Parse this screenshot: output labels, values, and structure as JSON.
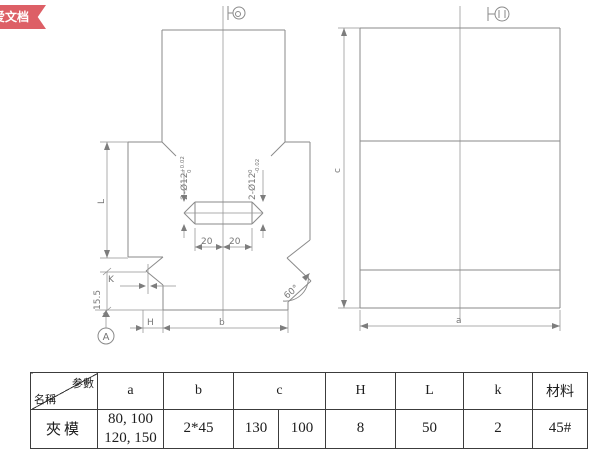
{
  "ribbon": {
    "label": "爱文档",
    "color": "#dd5f66"
  },
  "colors": {
    "line": "#8a8a8a",
    "table_border": "#3c3c3c",
    "dim_text": "#767676"
  },
  "drawing": {
    "front": {
      "hole_left_label": "2-Ø12",
      "hole_left_tol_upper": "+0.02",
      "hole_left_tol_lower": "0",
      "hole_right_label": "2-Ø12",
      "hole_right_tol_upper": "0",
      "hole_right_tol_lower": "-0.02",
      "slot_dim_left": "20",
      "slot_dim_right": "20",
      "dim_L": "L",
      "dim_K": "K",
      "dim_155": "15.5",
      "dim_H": "H",
      "dim_b": "b",
      "dim_angle": "60°",
      "datum_label": "A"
    },
    "side": {
      "dim_c": "c",
      "dim_a": "a"
    }
  },
  "table": {
    "corner": {
      "param": "参數",
      "name": "名稱"
    },
    "headers": {
      "a": "a",
      "b": "b",
      "c": "c",
      "H": "H",
      "L": "L",
      "k": "k",
      "material": "材料"
    },
    "row": {
      "name": "夾模",
      "a_line1": "80, 100",
      "a_line2": "120, 150",
      "b": "2*45",
      "c1": "130",
      "c2": "100",
      "H": "8",
      "L": "50",
      "k": "2",
      "material": "45#"
    }
  }
}
